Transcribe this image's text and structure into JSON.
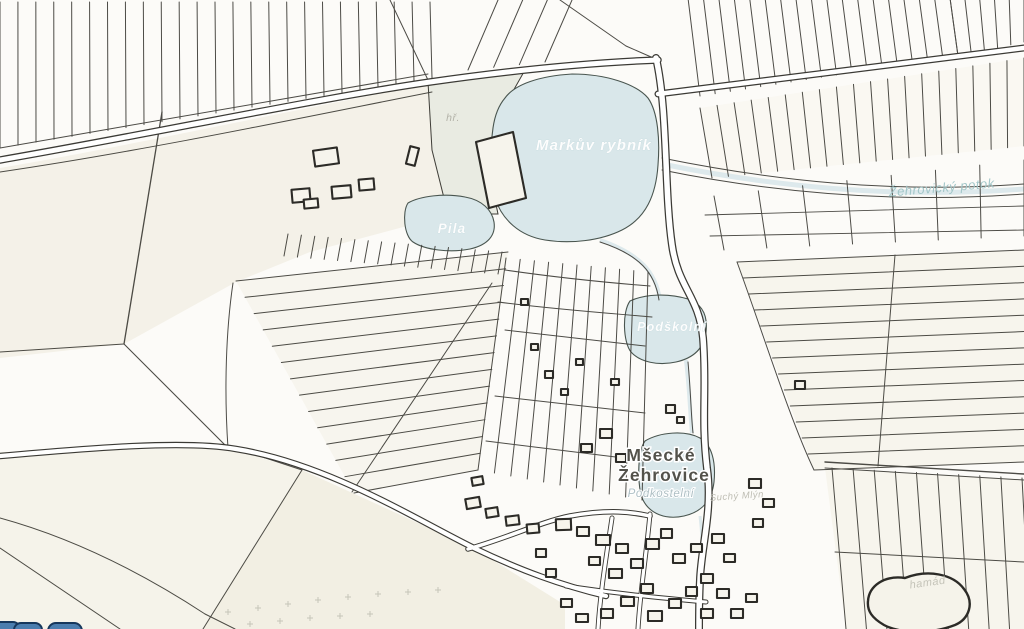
{
  "map": {
    "kind": "cadastral parcel map",
    "labels": {
      "lake_main": "Markův rybník",
      "pond_pila": "Pila",
      "pond_podskolni": "Podškolní",
      "village_line1": "Mšecké",
      "village_line2": "Žehrovice",
      "pond_podkostelni": "Podkostelní",
      "stream": "Žehrovický potok",
      "playground_abbr": "hř.",
      "minor_label_1": "Suchý Mlýn",
      "minor_label_2": "hamád"
    },
    "colors": {
      "background": "#fcfbf8",
      "parcel_line": "#3e3d37",
      "building_line": "#2c2b27",
      "building_fill": "#f6f4ec",
      "cream_field": "#f4f1e8",
      "cream_field_light": "#f7f5ee",
      "park_green": "#e9ebe2",
      "water_fill": "#d9e7ea",
      "water_outline": "#49554f",
      "road_fill": "#ffffff",
      "road_casing": "#3b3a35",
      "village_label": "#53524b",
      "stream_label": "#a3c7c9",
      "faint_label": "#b7b6ac",
      "garden_mark": "#c6c5b8",
      "logo_blue": "#4b7dae",
      "logo_edge": "#16375c"
    }
  }
}
